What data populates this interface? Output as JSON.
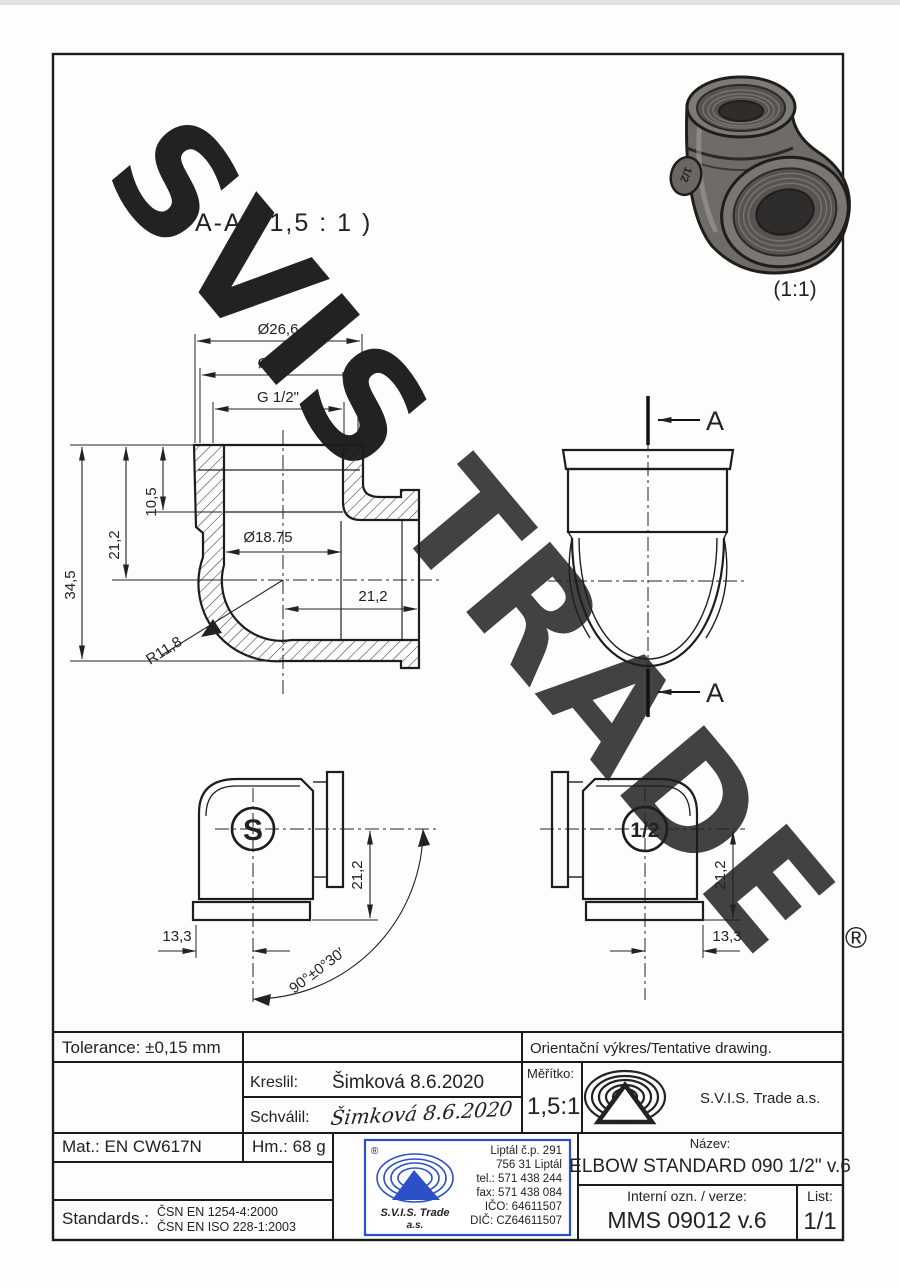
{
  "w": {
    "word_gray": "SVIS",
    "word_yellow": "TRADE",
    "reg": "®",
    "gray": "#ced1d4",
    "yellow": "#f8d893"
  },
  "photo": {
    "scale": "(1:1)",
    "badge": "1/2"
  },
  "sec": {
    "title": "A-A ( 1,5 : 1 )"
  },
  "dims": {
    "d_outer": "Ø26,6",
    "d_mouth": "Ø25,5",
    "thread": "G 1/2\"",
    "t_depth": "10,5",
    "t_axis": "21,2",
    "height": "34,5",
    "bore": "Ø18.75",
    "r_axis": "21,2",
    "radius": "R11,8"
  },
  "side": {
    "cut": "A"
  },
  "front": {
    "badge": "S",
    "w": "13,3",
    "h": "21,2",
    "angle": "90°±0°30′"
  },
  "back": {
    "badge": "1/2",
    "h": "21,2",
    "w": "13,3"
  },
  "tb": {
    "tolerance": "Tolerance: ±0,15 mm",
    "tentative": "Orientační výkres/Tentative drawing.",
    "kreslil_label": "Kreslil:",
    "kreslil_value": "Šimková 8.6.2020",
    "schvalil_label": "Schválil:",
    "schvalil_value": "Šimková 8.6.2020",
    "meritko_label": "Měřítko:",
    "meritko_value": "1,5:1",
    "company": "S.V.I.S. Trade a.s.",
    "mat": "Mat.: EN CW617N",
    "hm": "Hm.: 68 g",
    "standards_label": "Standards.:",
    "standards": [
      "ČSN EN 1254-4:2000",
      "ČSN EN ISO 228-1:2003"
    ],
    "nazev_label": "Název:",
    "nazev_value": "ELBOW STANDARD 090 1/2\" v.6",
    "interni_label": "Interní ozn. / verze:",
    "interni_value": "MMS 09012 v.6",
    "list_label": "List:",
    "list_value": "1/1",
    "stamp": {
      "reg": "®",
      "company1": "S.V.I.S. Trade",
      "company2": "a.s.",
      "addr": [
        "Liptál č.p. 291",
        "756 31 Liptál",
        "tel.: 571 438 244",
        "fax: 571 438 084",
        "IČO: 64611507",
        "DIČ: CZ64611507"
      ],
      "blue": "#2b50c8"
    }
  }
}
